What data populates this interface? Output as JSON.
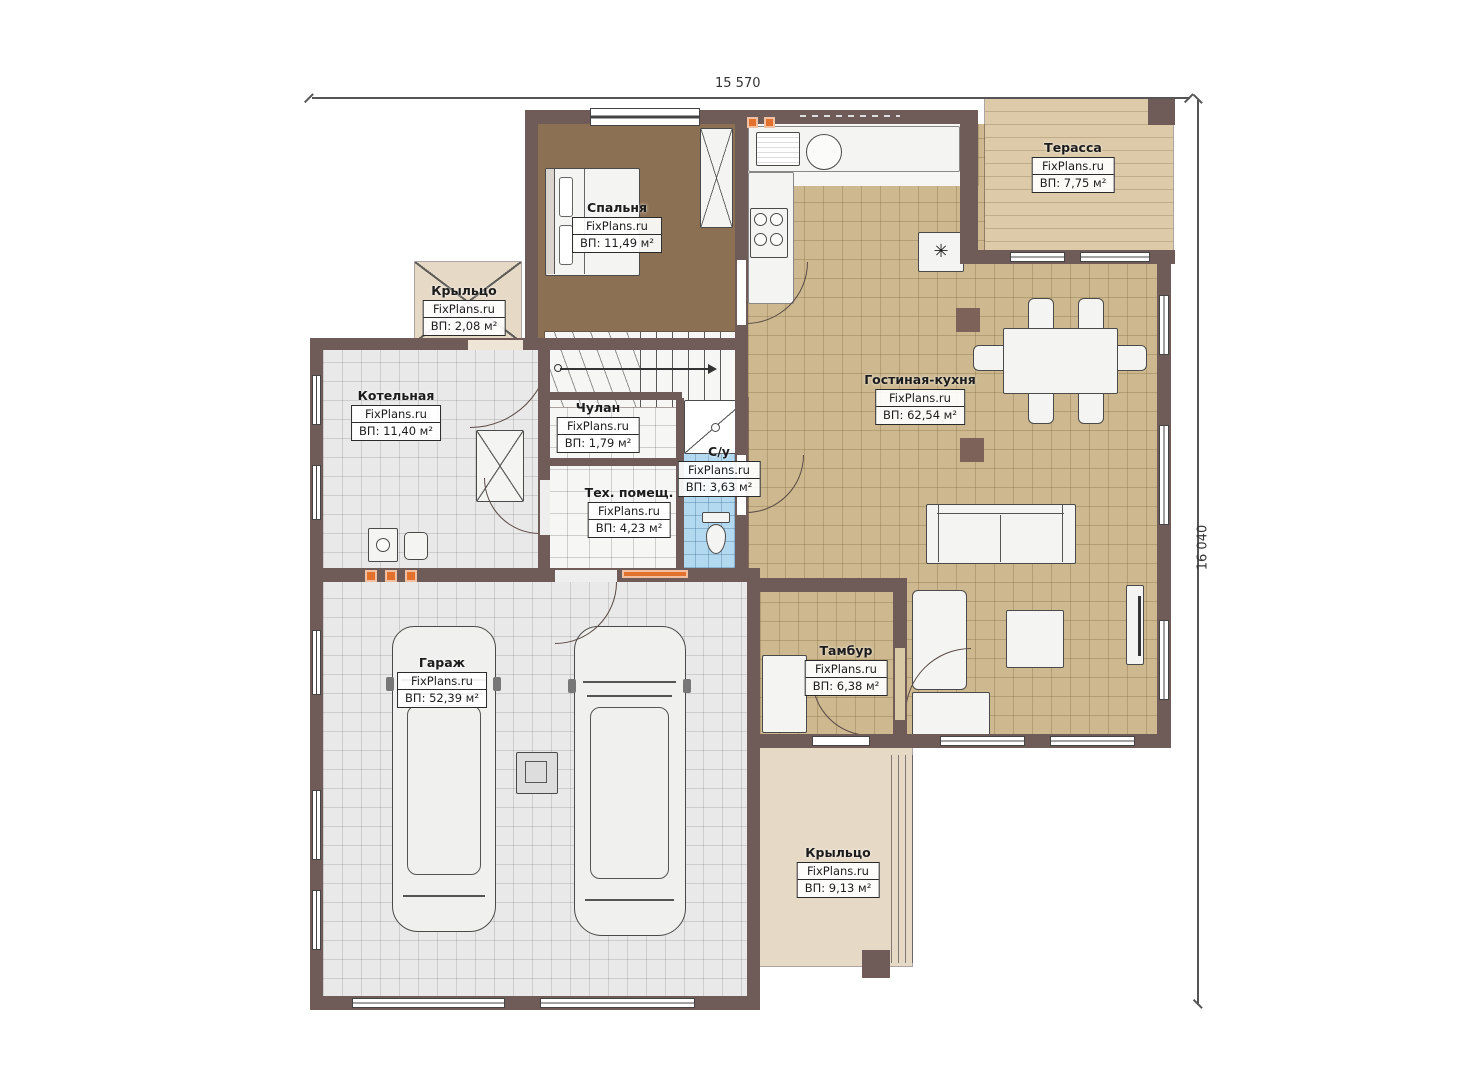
{
  "dimensions": {
    "width_label": "15 570",
    "height_label": "16 040"
  },
  "brand": "FixPlans.ru",
  "rooms": {
    "bedroom": {
      "name": "Спальня",
      "brand": "FixPlans.ru",
      "area": "ВП: 11,49 м²"
    },
    "terrace": {
      "name": "Терасса",
      "brand": "FixPlans.ru",
      "area": "ВП: 7,75 м²"
    },
    "porch_top": {
      "name": "Крыльцо",
      "brand": "FixPlans.ru",
      "area": "ВП: 2,08 м²"
    },
    "boiler": {
      "name": "Котельная",
      "brand": "FixPlans.ru",
      "area": "ВП: 11,40 м²"
    },
    "closet": {
      "name": "Чулан",
      "brand": "FixPlans.ru",
      "area": "ВП: 1,79 м²"
    },
    "bathroom": {
      "name": "С/у",
      "brand": "FixPlans.ru",
      "area": "ВП: 3,63 м²"
    },
    "tech": {
      "name": "Тех. помещ.",
      "brand": "FixPlans.ru",
      "area": "ВП: 4,23 м²"
    },
    "living": {
      "name": "Гостиная-кухня",
      "brand": "FixPlans.ru",
      "area": "ВП: 62,54 м²"
    },
    "vestibule": {
      "name": "Тамбур",
      "brand": "FixPlans.ru",
      "area": "ВП: 6,38 м²"
    },
    "garage": {
      "name": "Гараж",
      "brand": "FixPlans.ru",
      "area": "ВП: 52,39 м²"
    },
    "porch_bottom": {
      "name": "Крыльцо",
      "brand": "FixPlans.ru",
      "area": "ВП: 9,13 м²"
    }
  },
  "icons": {
    "fireplace": "✳"
  },
  "colors": {
    "wall": "#6f5b58",
    "floor_tan": "#cdb88f",
    "floor_gray": "#e9e9e9",
    "floor_blue": "#b3d9f0",
    "floor_brown": "#8b7054",
    "porch_beige": "#e6d9c6",
    "accent_orange": "#e2712e"
  }
}
